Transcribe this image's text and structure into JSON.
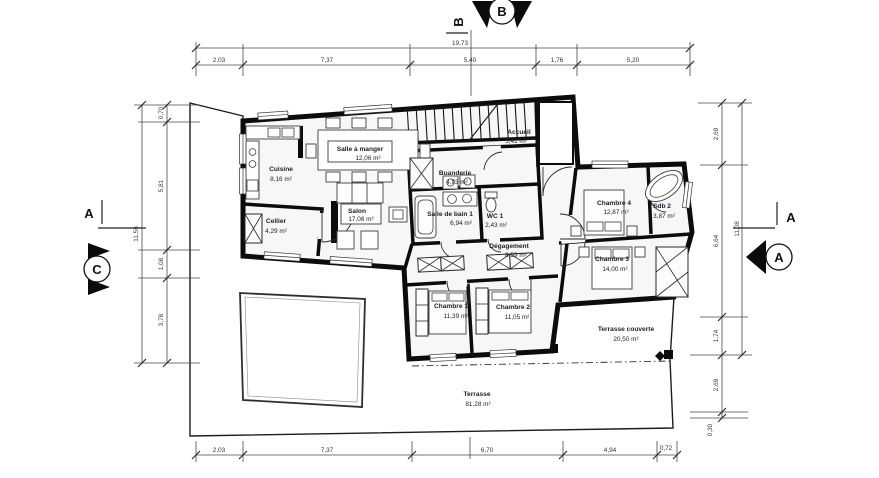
{
  "plan": {
    "rooms": {
      "cuisine": {
        "name": "Cuisine",
        "area": "8,16 m²"
      },
      "salle_a_manger": {
        "name": "Salle à manger",
        "area": "12,06 m²"
      },
      "salon": {
        "name": "Salon",
        "area": "17,08 m²"
      },
      "cellier": {
        "name": "Cellier",
        "area": "4,29 m²"
      },
      "accueil": {
        "name": "Accueil",
        "area": "5,41 m²"
      },
      "buanderie": {
        "name": "Buanderie",
        "area": "4,93 m²"
      },
      "sdb1": {
        "name": "Salle de bain 1",
        "area": "6,94 m²"
      },
      "wc1": {
        "name": "WC 1",
        "area": "2,43 m²"
      },
      "degagement": {
        "name": "Dégagement",
        "area": "8,59 m²"
      },
      "chambre1": {
        "name": "Chambre 1",
        "area": "11,39 m²"
      },
      "chambre2": {
        "name": "Chambre 2",
        "area": "11,05 m²"
      },
      "chambre3": {
        "name": "Chambre 3",
        "area": "14,00 m²"
      },
      "chambre4": {
        "name": "Chambre 4",
        "area": "12,87 m²"
      },
      "sdb2": {
        "name": "Sdb 2",
        "area": "3,87 m²"
      },
      "terrasse_couverte": {
        "name": "Terrasse couverte",
        "area": "20,50 m²"
      },
      "terrasse": {
        "name": "Terrasse",
        "area": "81,28 m²"
      }
    },
    "dims": {
      "top": {
        "overall": "19,73",
        "segs": [
          "2,03",
          "7,37",
          "5,40",
          "1,76",
          "5,20"
        ]
      },
      "bottom": {
        "segs": [
          "2,03",
          "7,37",
          "6,70",
          "4,94",
          "0,72"
        ]
      },
      "left": {
        "overall": "11,56",
        "segs": [
          "0,70",
          "5,81",
          "1,08",
          "3,78"
        ]
      },
      "right": {
        "overall": "11,08",
        "segs": [
          "2,69",
          "6,64",
          "1,74",
          "2,69",
          "0,30"
        ]
      }
    },
    "markers": {
      "a": "A",
      "b": "B",
      "c": "C"
    }
  }
}
